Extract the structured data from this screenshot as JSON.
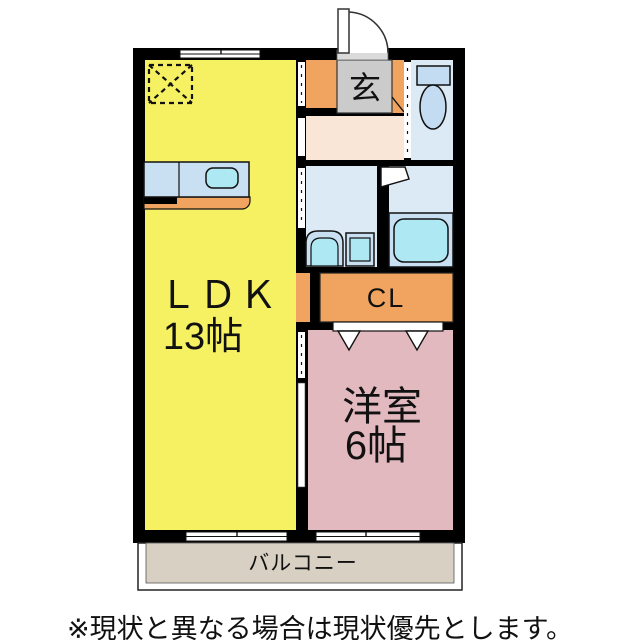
{
  "floorplan": {
    "labels": {
      "entrance": "玄",
      "ldk": "ＬＤＫ",
      "ldk_size": "13帖",
      "closet": "CL",
      "western_room": "洋室",
      "western_room_size": "6帖",
      "balcony": "バルコニー"
    },
    "colors": {
      "wall": "#000000",
      "ldk_fill": "#F6F063",
      "western_room_fill": "#E2B9BF",
      "closet_fill": "#F0A45F",
      "entrance_step_fill": "#CBCBCB",
      "entrance_threshold_fill": "#DADADA",
      "hallway_fill": "#FAE6D7",
      "wet_area_fill": "#DCEAF6",
      "fixture_fill": "#C9E0F2",
      "fixture_accent": "#AEE8F2",
      "toilet_fixture_fill": "#C3DCF2",
      "balcony_fill": "#D8D1C3"
    }
  },
  "caption": "※現状と異なる場合は現状優先とします。"
}
